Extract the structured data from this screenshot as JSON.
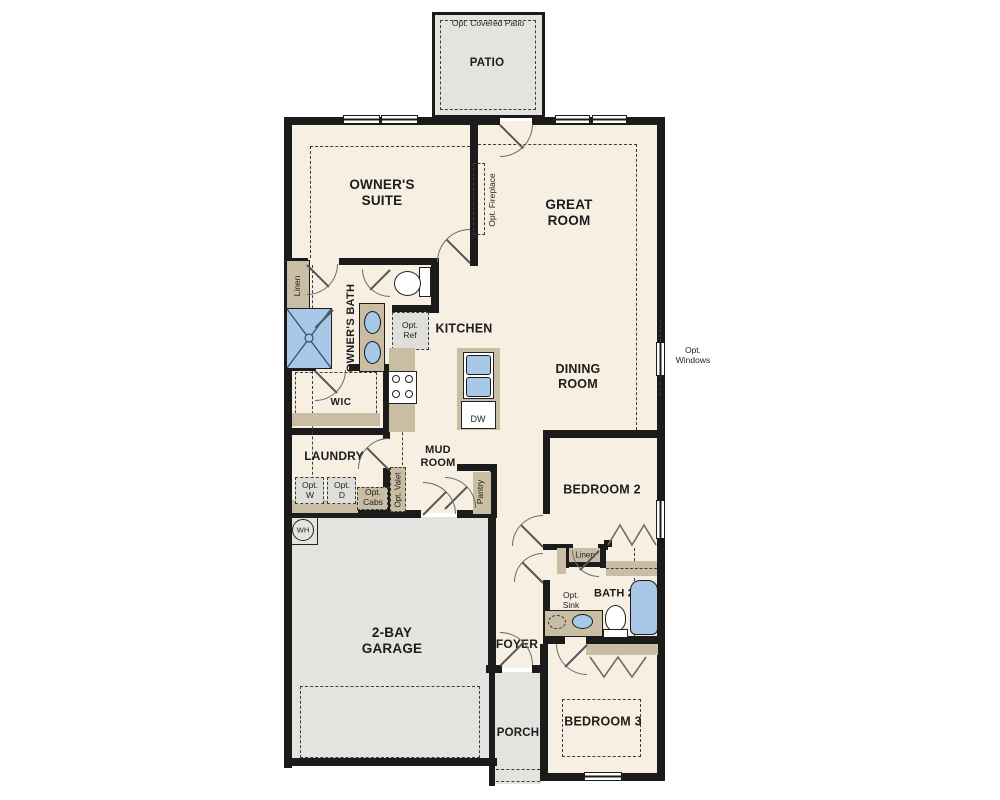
{
  "colors": {
    "floor": "#f7efe2",
    "wall": "#1b1b1b",
    "exterior_concrete": "#e4e3df",
    "casework_tan": "#c9bda3",
    "fixture_blue": "#a8c8e8",
    "option_gray": "#dededa"
  },
  "labels": {
    "opt_covered_patio": "Opt. Covered Patio",
    "patio": "PATIO",
    "owners_suite": "OWNER'S SUITE",
    "great_room": "GREAT ROOM",
    "opt_fireplace": "Opt. Fireplace",
    "linen_owners": "Linen",
    "owners_bath": "OWNER'S BATH",
    "opt_ref": "Opt. Ref",
    "kitchen": "KITCHEN",
    "dining_room": "DINING ROOM",
    "opt_windows": "Opt. Windows",
    "wic": "WIC",
    "dw": "DW",
    "laundry": "LAUNDRY",
    "mud_room": "MUD ROOM",
    "opt_w": "Opt. W",
    "opt_d": "Opt. D",
    "opt_cabs": "Opt. Cabs",
    "opt_valet": "Opt. Valet",
    "pantry": "Pantry",
    "wh": "WH",
    "garage": "2-BAY GARAGE",
    "bedroom2": "BEDROOM 2",
    "linen_bath2": "Linen",
    "bath2": "BATH 2",
    "opt_sink": "Opt. Sink",
    "foyer": "FOYER",
    "porch": "PORCH",
    "bedroom3": "BEDROOM 3"
  }
}
